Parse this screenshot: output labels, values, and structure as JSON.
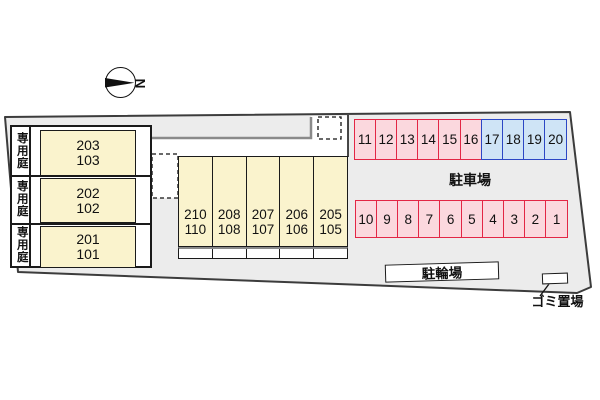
{
  "compass": {
    "label": "N"
  },
  "left_building": {
    "rows": [
      {
        "garden": "専用庭",
        "upper": "203",
        "lower": "103"
      },
      {
        "garden": "専用庭",
        "upper": "202",
        "lower": "102"
      },
      {
        "garden": "専用庭",
        "upper": "201",
        "lower": "101"
      }
    ]
  },
  "center_building": {
    "units": [
      {
        "upper": "210",
        "lower": "110"
      },
      {
        "upper": "208",
        "lower": "108"
      },
      {
        "upper": "207",
        "lower": "107"
      },
      {
        "upper": "206",
        "lower": "106"
      },
      {
        "upper": "205",
        "lower": "105"
      }
    ]
  },
  "parking": {
    "label": "駐車場",
    "top_row": [
      {
        "num": "11",
        "type": "red"
      },
      {
        "num": "12",
        "type": "red"
      },
      {
        "num": "13",
        "type": "red"
      },
      {
        "num": "14",
        "type": "red"
      },
      {
        "num": "15",
        "type": "red"
      },
      {
        "num": "16",
        "type": "red"
      },
      {
        "num": "17",
        "type": "blue"
      },
      {
        "num": "18",
        "type": "blue"
      },
      {
        "num": "19",
        "type": "blue"
      },
      {
        "num": "20",
        "type": "blue"
      }
    ],
    "bottom_row": [
      {
        "num": "10",
        "type": "red"
      },
      {
        "num": "9",
        "type": "red"
      },
      {
        "num": "8",
        "type": "red"
      },
      {
        "num": "7",
        "type": "red"
      },
      {
        "num": "6",
        "type": "red"
      },
      {
        "num": "5",
        "type": "red"
      },
      {
        "num": "4",
        "type": "red"
      },
      {
        "num": "3",
        "type": "red"
      },
      {
        "num": "2",
        "type": "red"
      },
      {
        "num": "1",
        "type": "red"
      }
    ]
  },
  "facilities": {
    "bicycle_parking": "駐輪場",
    "garbage_area": "ゴミ置場"
  },
  "colors": {
    "site_fill": "#ececec",
    "site_border": "#3c3c3c",
    "unit_fill": "#faf3cd",
    "stall_red_fill": "#fbd8de",
    "stall_red_border": "#e32645",
    "stall_blue_fill": "#cfe4f6",
    "stall_blue_border": "#2c47c5",
    "gray_line": "#8a8a8a"
  }
}
